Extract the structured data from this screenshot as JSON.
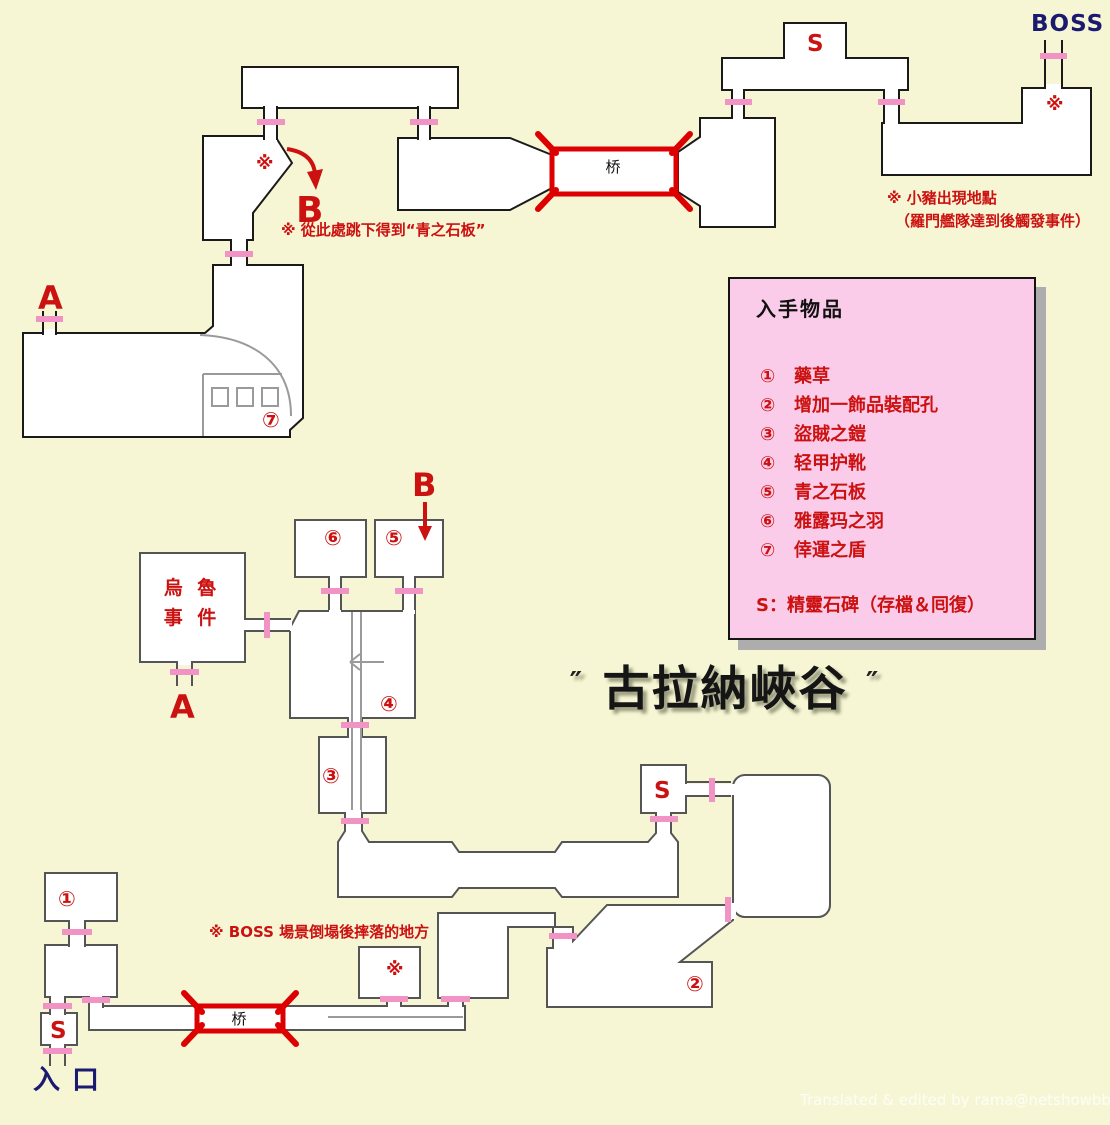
{
  "title": {
    "quote_left": "″",
    "text": "古拉納峽谷",
    "quote_right": "″"
  },
  "legend": {
    "title": "入手物品",
    "items": [
      {
        "num": "①",
        "label": "藥草"
      },
      {
        "num": "②",
        "label": "增加一飾品裝配孔"
      },
      {
        "num": "③",
        "label": "盜賊之鎧"
      },
      {
        "num": "④",
        "label": "轻甲护靴"
      },
      {
        "num": "⑤",
        "label": "青之石板"
      },
      {
        "num": "⑥",
        "label": "雅露玛之羽"
      },
      {
        "num": "⑦",
        "label": "倖運之盾"
      }
    ],
    "save_note": "S：精靈石碑（存檔＆囘復）"
  },
  "annotations": {
    "boss_label": "BOSS",
    "entrance_label": "入口",
    "pig_line1": "※ 小豬出現地點",
    "pig_line2": "（羅門艦隊達到後觸發事件）",
    "jump_note": "※ 從此處跳下得到“青之石板”",
    "boss_fall_note": "※ BOSS 場景倒塌後摔落的地方",
    "credit": "Translated & edited by rama@netshowbbs.com"
  },
  "map_labels": {
    "bridge": "桥",
    "save_point": "S",
    "point_a": "A",
    "point_b": "B",
    "star": "※",
    "uru_line1": "烏 魯",
    "uru_line2": "事 件",
    "item1": "①",
    "item2": "②",
    "item3": "③",
    "item4": "④",
    "item5": "⑤",
    "item6": "⑥",
    "item7": "⑦"
  },
  "colors": {
    "background": "#F6F6D4",
    "room_fill": "#FFFFFF",
    "wall_dark": "#1A1A1A",
    "wall_gray": "#555555",
    "door_pink": "#F193C5",
    "bridge_red": "#DD0000",
    "text_red": "#CC1111",
    "text_navy": "#1A1A70",
    "legend_bg": "#FBCCE9",
    "legend_shadow": "#ADADAD",
    "detail_gray": "#9A9A9A",
    "credit_white": "#FFFFFF"
  }
}
